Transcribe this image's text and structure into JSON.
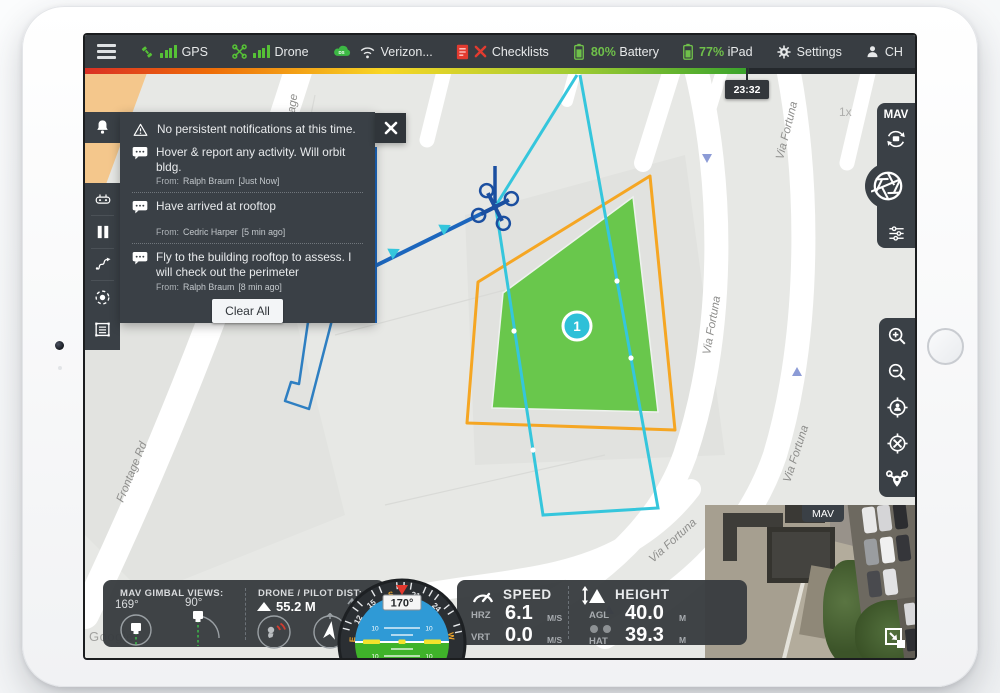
{
  "status_bar": {
    "gps": "GPS",
    "drone": "Drone",
    "network": "Verizon...",
    "network_cloud": "DS",
    "checklists": "Checklists",
    "battery_pct": "80%",
    "battery_label": "Battery",
    "ipad_pct": "77%",
    "ipad_label": "iPad",
    "settings": "Settings",
    "user": "CH"
  },
  "timeline": {
    "time": "23:32"
  },
  "map": {
    "zoom_indicator": "1x",
    "waypoint_number": "1",
    "watermark": "Google",
    "streets": {
      "frontage": "Frontage Rd",
      "frontage_top": "Frontage",
      "via_fortuna": "Via Fortuna"
    },
    "colors": {
      "survey_fill": "#5ec43f",
      "survey_outline": "#f5a623",
      "flight_path": "#35c6dc",
      "trail": "#1c66bd"
    }
  },
  "notifications": {
    "header": "No persistent notifications at this time.",
    "messages": [
      {
        "text": "Hover & report any activity. Will orbit bldg.",
        "from_label": "From:",
        "sender": "Ralph Braum",
        "time": "[Just Now]"
      },
      {
        "text": "Have arrived at rooftop",
        "from_label": "From:",
        "sender": "Cedric Harper",
        "time": "[5 min ago]"
      },
      {
        "text": "Fly to the building rooftop to assess. I will check out the perimeter",
        "from_label": "From:",
        "sender": "Ralph Braum",
        "time": "[8 min ago]"
      }
    ],
    "clear_all": "Clear All"
  },
  "camera_panel": {
    "title": "MAV"
  },
  "pip": {
    "title": "MAV"
  },
  "telemetry": {
    "gimbal": {
      "title": "MAV GIMBAL VIEWS:",
      "angle1": "169°",
      "angle2": "90°"
    },
    "distance": {
      "title": "DRONE / PILOT DIST:",
      "value": "55.2 M"
    },
    "horizon": {
      "heading": "170°",
      "compass": [
        "12",
        "15",
        "S",
        "21",
        "24"
      ],
      "east": "E",
      "west": "W",
      "pitch_10": "10",
      "pitch_20": "20",
      "pitch_30": "30"
    },
    "speed": {
      "title": "SPEED",
      "hrz_label": "HRZ",
      "hrz_value": "6.1",
      "vrt_label": "VRT",
      "vrt_value": "0.0",
      "unit": "M/S"
    },
    "height": {
      "title": "HEIGHT",
      "agl_label": "AGL",
      "agl_value": "40.0",
      "hat_label": "HAT",
      "hat_value": "39.3",
      "unit": "M"
    }
  }
}
